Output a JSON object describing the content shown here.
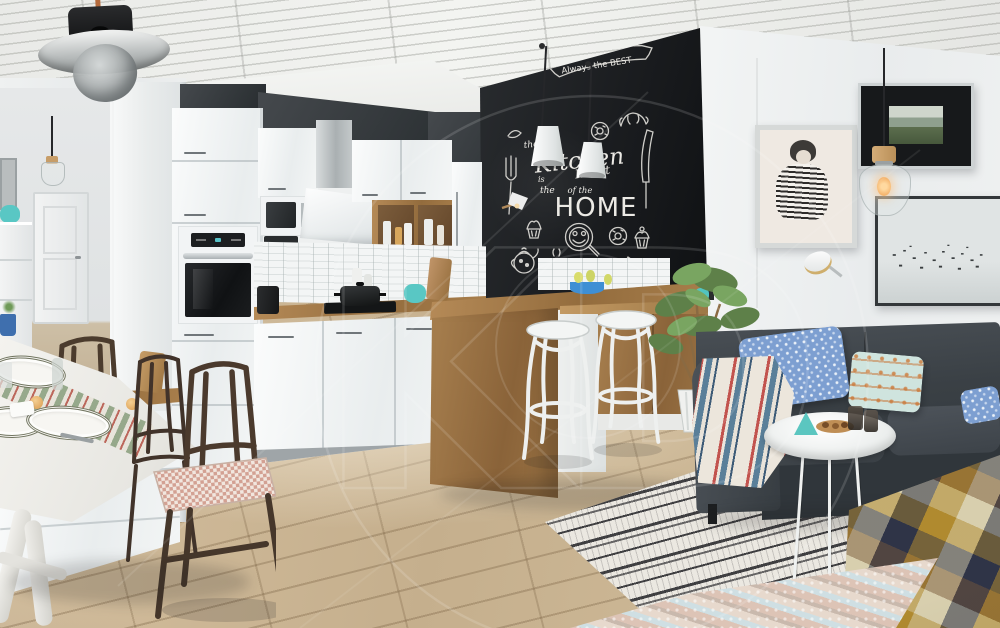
{
  "watermark": {
    "monogram": "KD"
  },
  "chalkboard": {
    "banner": "Always the BEST",
    "the1": "the",
    "kitchen": "Kitchen",
    "is": "is",
    "the2": "the",
    "heart": "Heart",
    "of_the": "of the",
    "home": "HOME"
  },
  "icons": {
    "chalk_doodles": [
      "fork-icon",
      "knife-icon",
      "croissant-icon",
      "donut-icon",
      "cupcake-icon",
      "teapot-icon",
      "coffee-cup-icon",
      "smiley-pan-icon",
      "cake-slice-icon",
      "ribbon-banner-icon"
    ]
  },
  "palette": {
    "chalkboard": "#1a1c1f",
    "chalk": "#e8e6e1",
    "accent_wall": "#34393c",
    "cabinet_white": "#f4f6f6",
    "counter_wood": "#a8804f",
    "floor_wood": "#c9b392",
    "sofa": "#3a4045",
    "pillow_blue": "#7d9fd1",
    "teal_accent": "#5bc6c0",
    "rug_ink": "#26262a",
    "plaid_mustard": "#b08a2f",
    "throw_red": "#c2534e"
  }
}
